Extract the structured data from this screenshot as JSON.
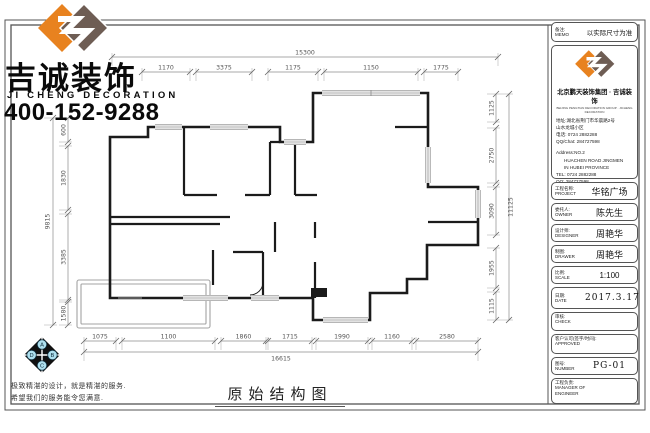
{
  "branding": {
    "company_cn": "吉诚装饰",
    "company_en": "JI CHENG DECORATION",
    "phone": "400-152-9288",
    "slogan_line1": "极致精湛的设计，就是精湛的服务.",
    "slogan_line2": "希望我们的服务能令您满意.",
    "badge_letters": [
      "A",
      "B",
      "C",
      "D"
    ]
  },
  "drawing": {
    "title": "原始结构图",
    "dims_top": {
      "overall": "15300",
      "segments": [
        "1170",
        "3375",
        "1175",
        "1150",
        "1775"
      ]
    },
    "dims_bottom": {
      "overall": "16615",
      "segments": [
        "1075",
        "1100",
        "1860",
        "1715",
        "1990",
        "1160",
        "2580"
      ]
    },
    "dims_left": {
      "overall": "9815",
      "segments": [
        "600",
        "1830",
        "3385",
        "1580"
      ]
    },
    "dims_right": {
      "overall": "11125",
      "segments": [
        "1125",
        "2750",
        "3090",
        "1955",
        "1115"
      ]
    }
  },
  "titleblock": {
    "memo": {
      "cn": "备注:",
      "en": "MEMO",
      "value": "以实际尺寸为准"
    },
    "company_line": "北京鹏天装饰集团 · 吉诚装饰",
    "company_sub": "BEIJING PENGTIAN DECORATION GROUP · JICHENG DECORATION",
    "addr1": "地址:湖北省荆门市华晨路2号",
    "addr2": "山水龙城小区",
    "phone_cn": "电话: 0724 2882288",
    "qq_cn": "QQ/Chat: 284727598",
    "addr_en1": "Address:NO.2",
    "addr_en2": "HUACHEN ROAD JINGMEN",
    "addr_en3": "IN HUBEI PROVINCE",
    "tel_en": "TEL: 0724 2882288",
    "qq_en": "QQ: 284727598",
    "fields": [
      {
        "cn": "工程名称:",
        "en": "PROJECT",
        "value": "华铭广场"
      },
      {
        "cn": "委托人:",
        "en": "OWNER",
        "value": "陈先生"
      },
      {
        "cn": "设计师:",
        "en": "DESIGNER",
        "value": "周艳华"
      },
      {
        "cn": "制图:",
        "en": "DRAWER",
        "value": "周艳华"
      },
      {
        "cn": "比例:",
        "en": "SCALE",
        "value": "1:100"
      },
      {
        "cn": "日期:",
        "en": "DATE",
        "value": "2017.3.17"
      },
      {
        "cn": "审核:",
        "en": "CHECK",
        "value": ""
      },
      {
        "cn": "客户认可(签字/时间):",
        "en": "APPROVED",
        "value": ""
      },
      {
        "cn": "图号:",
        "en": "NUMBER",
        "value": "PG-01"
      },
      {
        "cn": "工程负责:",
        "en": "MANAGER OF ENGINEER",
        "value": ""
      }
    ]
  }
}
